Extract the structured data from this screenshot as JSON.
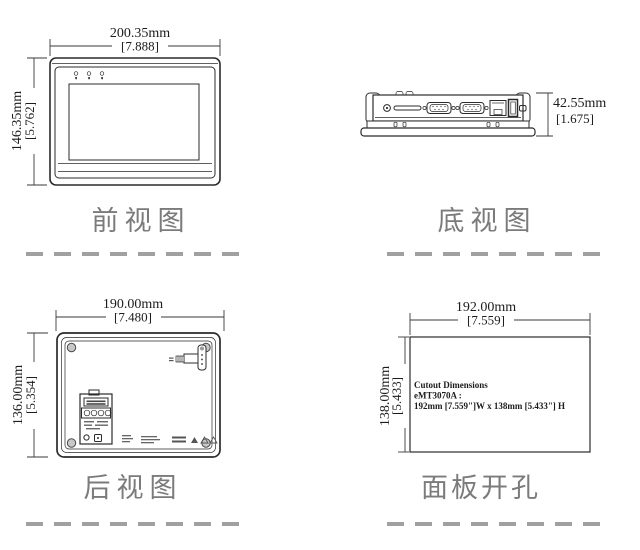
{
  "views": {
    "front": {
      "label": "前视图",
      "width_mm": "200.35mm",
      "width_in": "[7.888]",
      "height_mm": "146.35mm",
      "height_in": "[5.762]"
    },
    "bottom": {
      "label": "底视图",
      "height_mm": "42.55mm",
      "height_in": "[1.675]"
    },
    "rear": {
      "label": "后视图",
      "width_mm": "190.00mm",
      "width_in": "[7.480]",
      "height_mm": "136.00mm",
      "height_in": "[5.354]"
    },
    "cutout": {
      "label": "面板开孔",
      "width_mm": "192.00mm",
      "width_in": "[7.559]",
      "height_mm": "138.00mm",
      "height_in": "[5.433]",
      "note_line1": "Cutout Dimensions",
      "note_line2": "eMT3070A :",
      "note_line3": "192mm [7.559\"]W x 138mm [5.433\"] H"
    }
  },
  "colors": {
    "line": "#2b2b2b",
    "label_gray": "#7b7b7b",
    "dash_gray": "#a0a0a0"
  }
}
